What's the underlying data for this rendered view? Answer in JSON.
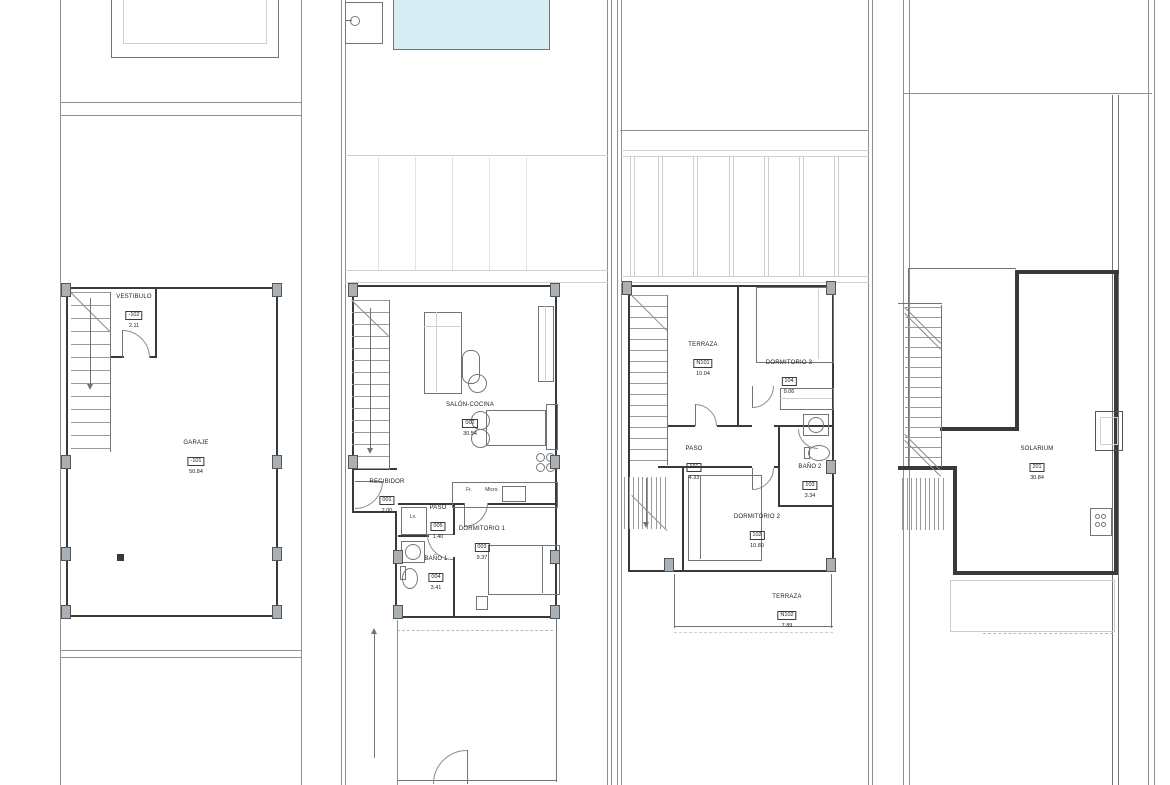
{
  "document_type": "architectural-floor-plans",
  "palette": {
    "wall": "#3a3a3a",
    "thin_line": "#737373",
    "plot_line": "#8f8f8f",
    "faint_line": "#cfcfcf",
    "pool_fill": "#d9edf4",
    "pool_stroke": "#5b7d8a",
    "column_fill": "#a9b1b7",
    "background": "#ffffff"
  },
  "plans": [
    {
      "name": "basement-garage-level",
      "rooms": [
        {
          "label": "VESTIBULO",
          "code": "-102",
          "area": "2.11"
        },
        {
          "label": "GARAJE",
          "code": "-101",
          "area": "50.84"
        }
      ],
      "annotations": []
    },
    {
      "name": "ground-floor",
      "rooms": [
        {
          "label": "SALÓN-COCINA",
          "code": "002",
          "area": "30.54"
        },
        {
          "label": "RECIBIDOR",
          "code": "001",
          "area": "2.00"
        },
        {
          "label": "PASO",
          "code": "005",
          "area": "1.40"
        },
        {
          "label": "BAÑO 1",
          "code": "004",
          "area": "3.41"
        },
        {
          "label": "DORMITORIO 1",
          "code": "003",
          "area": "9.37"
        }
      ],
      "annotations": [
        {
          "text": "Fr."
        },
        {
          "text": "Micro."
        },
        {
          "text": "Lv."
        }
      ]
    },
    {
      "name": "first-floor",
      "rooms": [
        {
          "label": "TERRAZA",
          "code": "N101",
          "area": "10.04"
        },
        {
          "label": "DORMITORIO 3",
          "code": "104",
          "area": "9.06"
        },
        {
          "label": "PASO",
          "code": "101",
          "area": "4.33"
        },
        {
          "label": "BAÑO 2",
          "code": "103",
          "area": "3.34"
        },
        {
          "label": "DORMITORIO 2",
          "code": "102",
          "area": "10.80"
        },
        {
          "label": "TERRAZA",
          "code": "N102",
          "area": "7.89"
        }
      ],
      "annotations": []
    },
    {
      "name": "roof-solarium",
      "rooms": [
        {
          "label": "SOLARIUM",
          "code": "201",
          "area": "30.84"
        }
      ],
      "annotations": []
    }
  ]
}
